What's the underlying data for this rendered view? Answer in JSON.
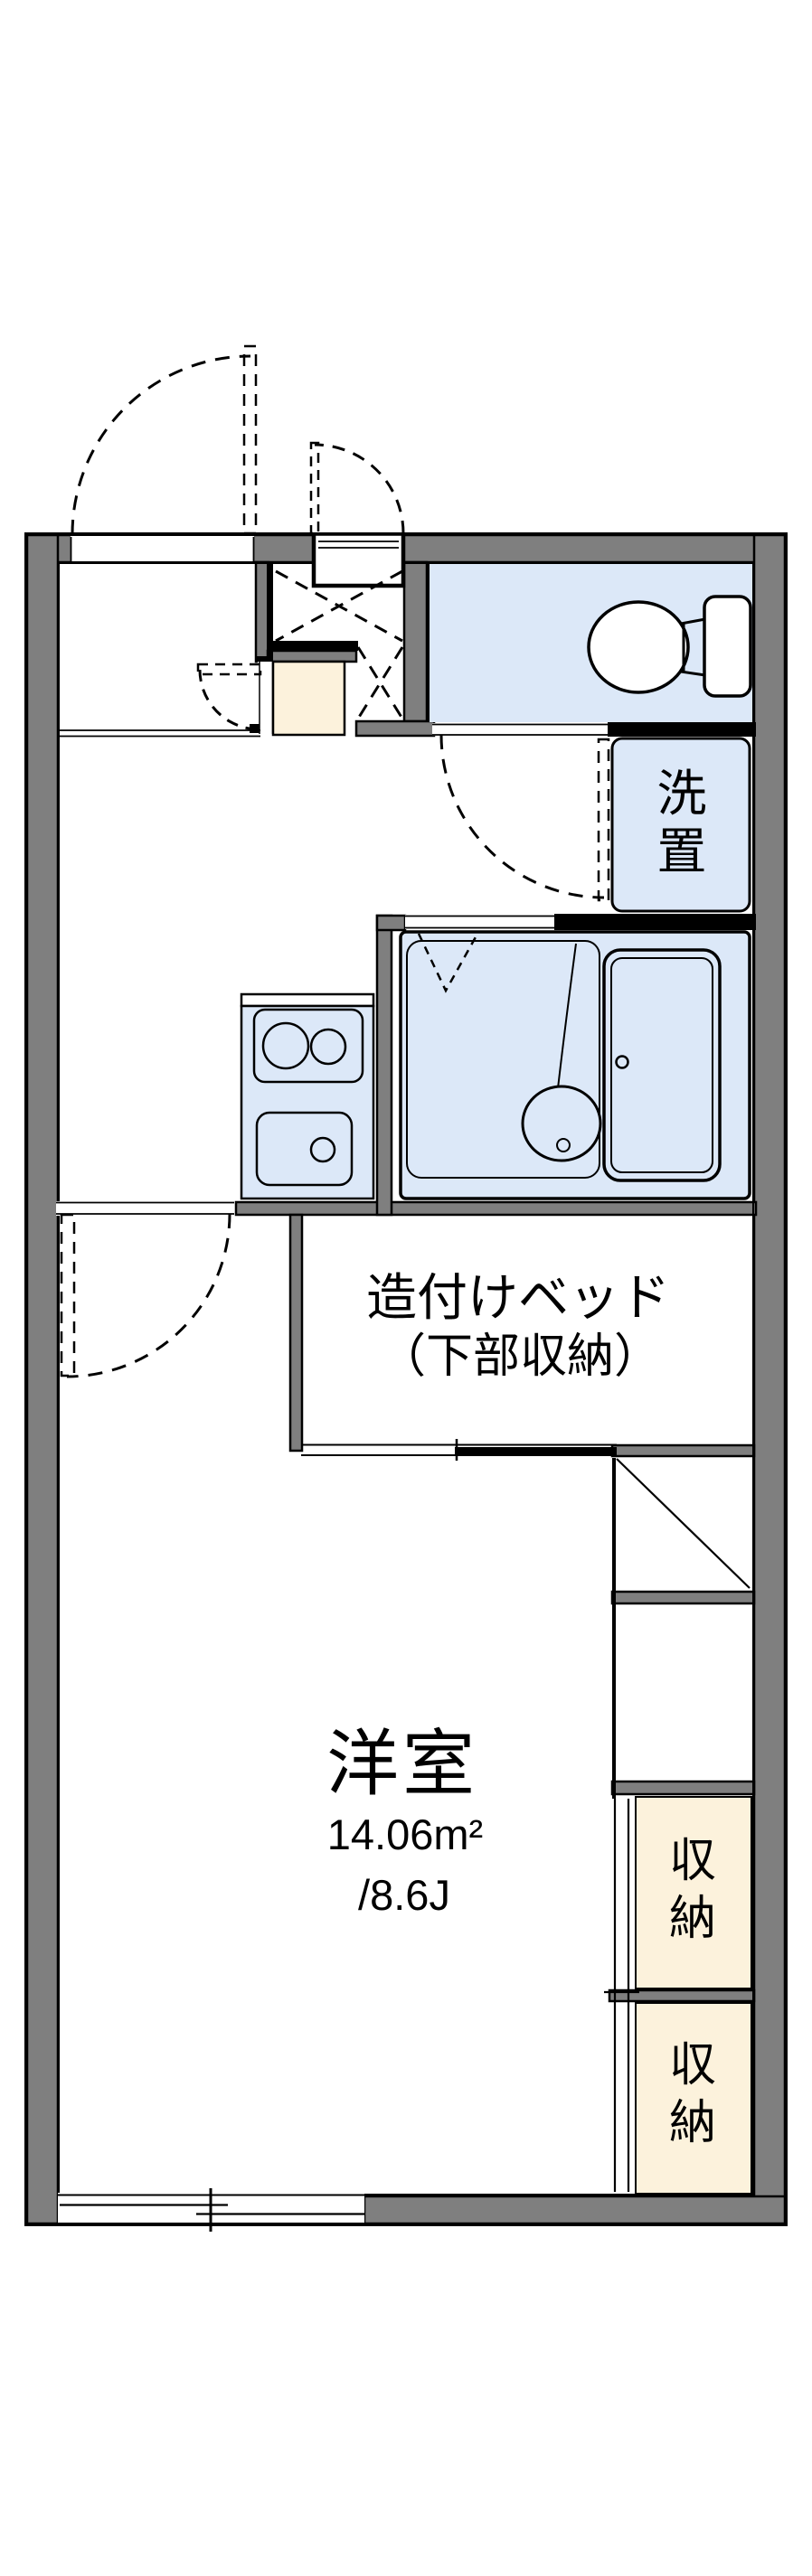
{
  "page": {
    "background": "#ffffff",
    "type": "apartment-floor-plan"
  },
  "colors": {
    "wall_gray": "#7f7f7f",
    "water_blue": "#dce8f8",
    "storage_cream": "#fcf2dc",
    "line_black": "#000000",
    "paper_white": "#ffffff"
  },
  "labels": {
    "washer_place": {
      "chars": [
        "洗",
        "置"
      ]
    },
    "built_in_bed": {
      "line1": "造付けベッド",
      "line2": "（下部収納）"
    },
    "western_room": {
      "name": "洋室",
      "area_sqm": "14.06m²",
      "area_tatami": "/8.6J"
    },
    "closet_upper": {
      "chars": [
        "収",
        "納"
      ]
    },
    "closet_lower": {
      "chars": [
        "収",
        "納"
      ]
    }
  }
}
